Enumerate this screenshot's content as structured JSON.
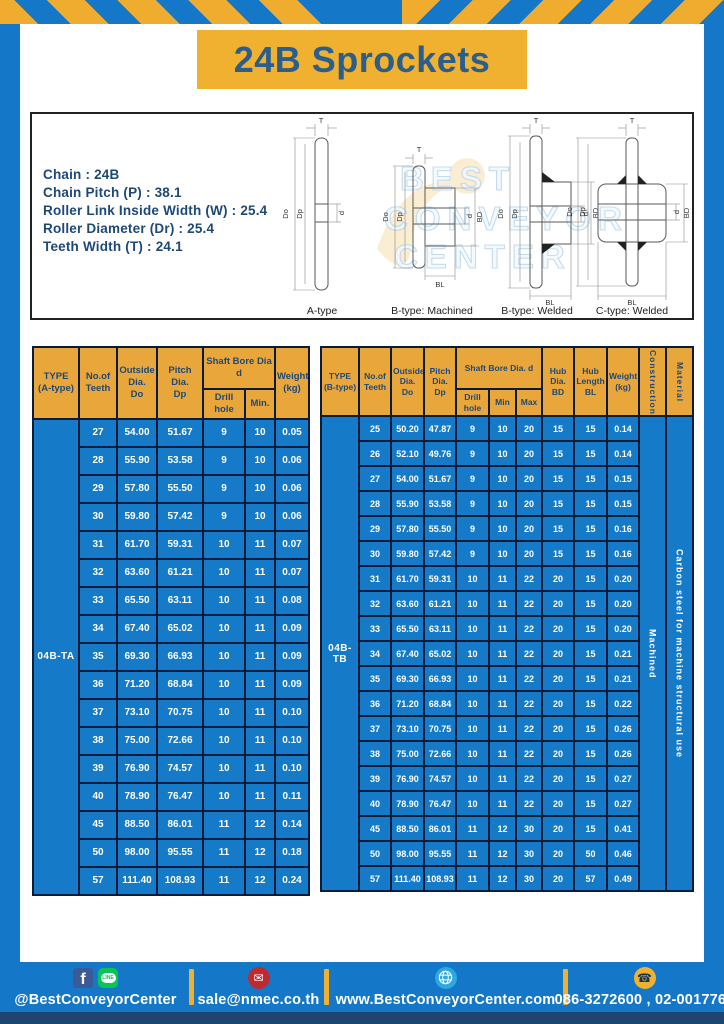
{
  "title": "24B Sprockets",
  "specs": {
    "lines": [
      "Chain  : 24B",
      "Chain Pitch (P)  :  38.1",
      "Roller Link Inside Width (W)  :  25.4",
      "Roller Diameter (Dr)  : 25.4",
      "Teeth Width (T)  :  24.1"
    ]
  },
  "drawings": {
    "watermark": [
      "BEST",
      "CONVEYOR",
      "CENTER"
    ],
    "captions": [
      "A-type",
      "B-type: Machined",
      "B-type: Welded",
      "C-type: Welded"
    ],
    "labels": {
      "t": "T",
      "dia_o": "Do",
      "dia_p": "Dp",
      "d": "d",
      "bd": "BD",
      "bl": "BL"
    }
  },
  "table_a": {
    "headers": {
      "type": "TYPE\n(A-type)",
      "teeth": "No.of\nTeeth",
      "outside": "Outside\nDia.\nDo",
      "pitch": "Pitch Dia.\nDp",
      "shaft": "Shaft Bore Dia d",
      "drill": "Drill hole",
      "min": "Min.",
      "weight": "Weight\n(kg)"
    },
    "type_value": "04B-TA",
    "rows": [
      [
        "27",
        "54.00",
        "51.67",
        "9",
        "10",
        "0.05"
      ],
      [
        "28",
        "55.90",
        "53.58",
        "9",
        "10",
        "0.06"
      ],
      [
        "29",
        "57.80",
        "55.50",
        "9",
        "10",
        "0.06"
      ],
      [
        "30",
        "59.80",
        "57.42",
        "9",
        "10",
        "0.06"
      ],
      [
        "31",
        "61.70",
        "59.31",
        "10",
        "11",
        "0.07"
      ],
      [
        "32",
        "63.60",
        "61.21",
        "10",
        "11",
        "0.07"
      ],
      [
        "33",
        "65.50",
        "63.11",
        "10",
        "11",
        "0.08"
      ],
      [
        "34",
        "67.40",
        "65.02",
        "10",
        "11",
        "0.09"
      ],
      [
        "35",
        "69.30",
        "66.93",
        "10",
        "11",
        "0.09"
      ],
      [
        "36",
        "71.20",
        "68.84",
        "10",
        "11",
        "0.09"
      ],
      [
        "37",
        "73.10",
        "70.75",
        "10",
        "11",
        "0.10"
      ],
      [
        "38",
        "75.00",
        "72.66",
        "10",
        "11",
        "0.10"
      ],
      [
        "39",
        "76.90",
        "74.57",
        "10",
        "11",
        "0.10"
      ],
      [
        "40",
        "78.90",
        "76.47",
        "10",
        "11",
        "0.11"
      ],
      [
        "45",
        "88.50",
        "86.01",
        "11",
        "12",
        "0.14"
      ],
      [
        "50",
        "98.00",
        "95.55",
        "11",
        "12",
        "0.18"
      ],
      [
        "57",
        "111.40",
        "108.93",
        "11",
        "12",
        "0.24"
      ]
    ]
  },
  "table_b": {
    "headers": {
      "type": "TYPE\n(B-type)",
      "teeth": "No.of\nTeeth",
      "outside": "Outside\nDia.\nDo",
      "pitch": "Pitch\nDia.\nDp",
      "shaft": "Shaft Bore Dia.  d",
      "drill": "Drill hole",
      "min": "Min",
      "max": "Max",
      "hub_dia": "Hub\nDia.\nBD",
      "hub_len": "Hub\nLength\nBL",
      "weight": "Weight\n(kg)",
      "construction": "Construction",
      "material": "Material"
    },
    "type_value": "04B-TB",
    "construction_value": "Machined",
    "material_value": "Carbon steel for machine structural use",
    "rows": [
      [
        "25",
        "50.20",
        "47.87",
        "9",
        "10",
        "20",
        "15",
        "15",
        "0.14"
      ],
      [
        "26",
        "52.10",
        "49.76",
        "9",
        "10",
        "20",
        "15",
        "15",
        "0.14"
      ],
      [
        "27",
        "54.00",
        "51.67",
        "9",
        "10",
        "20",
        "15",
        "15",
        "0.15"
      ],
      [
        "28",
        "55.90",
        "53.58",
        "9",
        "10",
        "20",
        "15",
        "15",
        "0.15"
      ],
      [
        "29",
        "57.80",
        "55.50",
        "9",
        "10",
        "20",
        "15",
        "15",
        "0.16"
      ],
      [
        "30",
        "59.80",
        "57.42",
        "9",
        "10",
        "20",
        "15",
        "15",
        "0.16"
      ],
      [
        "31",
        "61.70",
        "59.31",
        "10",
        "11",
        "22",
        "20",
        "15",
        "0.20"
      ],
      [
        "32",
        "63.60",
        "61.21",
        "10",
        "11",
        "22",
        "20",
        "15",
        "0.20"
      ],
      [
        "33",
        "65.50",
        "63.11",
        "10",
        "11",
        "22",
        "20",
        "15",
        "0.20"
      ],
      [
        "34",
        "67.40",
        "65.02",
        "10",
        "11",
        "22",
        "20",
        "15",
        "0.21"
      ],
      [
        "35",
        "69.30",
        "66.93",
        "10",
        "11",
        "22",
        "20",
        "15",
        "0.21"
      ],
      [
        "36",
        "71.20",
        "68.84",
        "10",
        "11",
        "22",
        "20",
        "15",
        "0.22"
      ],
      [
        "37",
        "73.10",
        "70.75",
        "10",
        "11",
        "22",
        "20",
        "15",
        "0.26"
      ],
      [
        "38",
        "75.00",
        "72.66",
        "10",
        "11",
        "22",
        "20",
        "15",
        "0.26"
      ],
      [
        "39",
        "76.90",
        "74.57",
        "10",
        "11",
        "22",
        "20",
        "15",
        "0.27"
      ],
      [
        "40",
        "78.90",
        "76.47",
        "10",
        "11",
        "22",
        "20",
        "15",
        "0.27"
      ],
      [
        "45",
        "88.50",
        "86.01",
        "11",
        "12",
        "30",
        "20",
        "15",
        "0.41"
      ],
      [
        "50",
        "98.00",
        "95.55",
        "11",
        "12",
        "30",
        "20",
        "50",
        "0.46"
      ],
      [
        "57",
        "111.40",
        "108.93",
        "11",
        "12",
        "30",
        "20",
        "57",
        "0.49"
      ]
    ]
  },
  "footer": {
    "fb_letter": "f",
    "line_text": "LINE",
    "social_label": "@BestConveyorCenter",
    "email": "sale@nmec.co.th",
    "website": "www.BestConveyorCenter.com",
    "phones": "086-3272600 , 02-0017766"
  },
  "colors": {
    "frame_blue": "#1577C8",
    "cell_blue": "#157AC8",
    "banner_yellow": "#F0B030",
    "header_yellow": "#E9A73B",
    "navy_text": "#1E4878",
    "border_navy": "#0A1C3A",
    "bottom_strip": "#1F4470",
    "line_green": "#06C755",
    "facebook_blue": "#3D5A98",
    "mail_red": "#BE2A2E",
    "globe_blue": "#2FA8E1"
  }
}
